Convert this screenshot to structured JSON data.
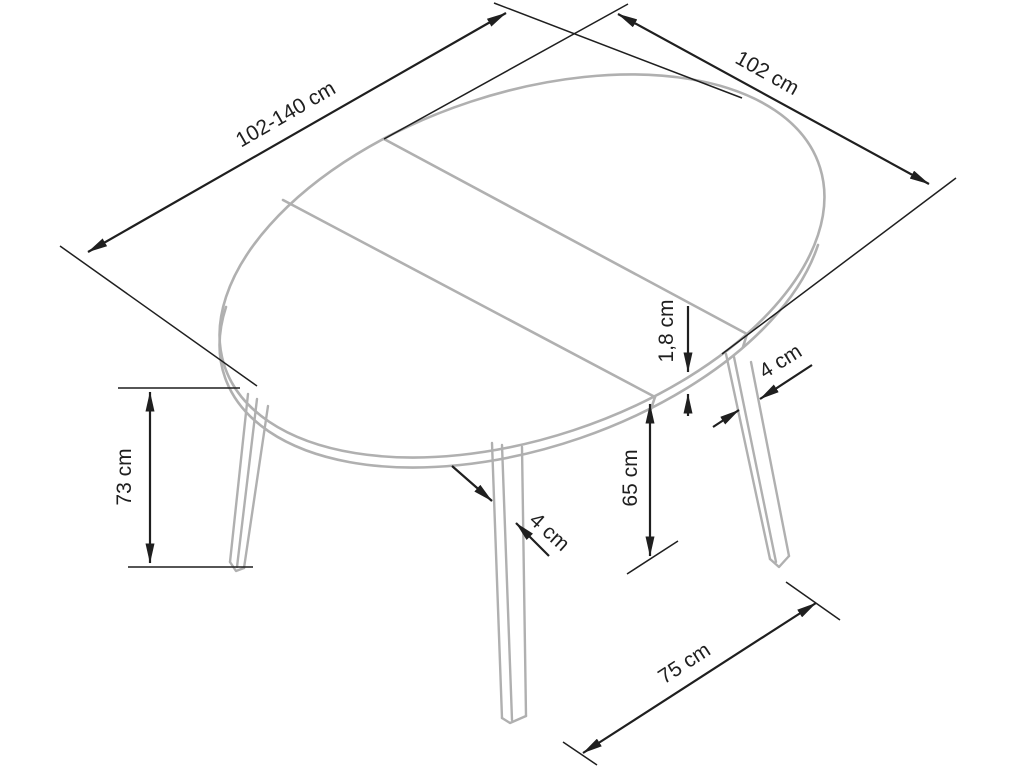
{
  "diagram": {
    "subject": "round extendable dining table - dimension drawing",
    "colors": {
      "object": "#b0b0b0",
      "dimension": "#1f1f1f",
      "label": "#1f1f1f",
      "background": "#ffffff"
    },
    "dimensions": [
      {
        "id": "tabletop-width-extended",
        "label": "102-140 cm"
      },
      {
        "id": "tabletop-depth",
        "label": "102 cm"
      },
      {
        "id": "tabletop-thickness",
        "label": "1,8 cm"
      },
      {
        "id": "leg-width-right",
        "label": "4 cm"
      },
      {
        "id": "table-height",
        "label": "73 cm"
      },
      {
        "id": "underside-clearance",
        "label": "65 cm"
      },
      {
        "id": "leg-width-front",
        "label": "4 cm"
      },
      {
        "id": "leg-spacing",
        "label": "75 cm"
      }
    ]
  }
}
